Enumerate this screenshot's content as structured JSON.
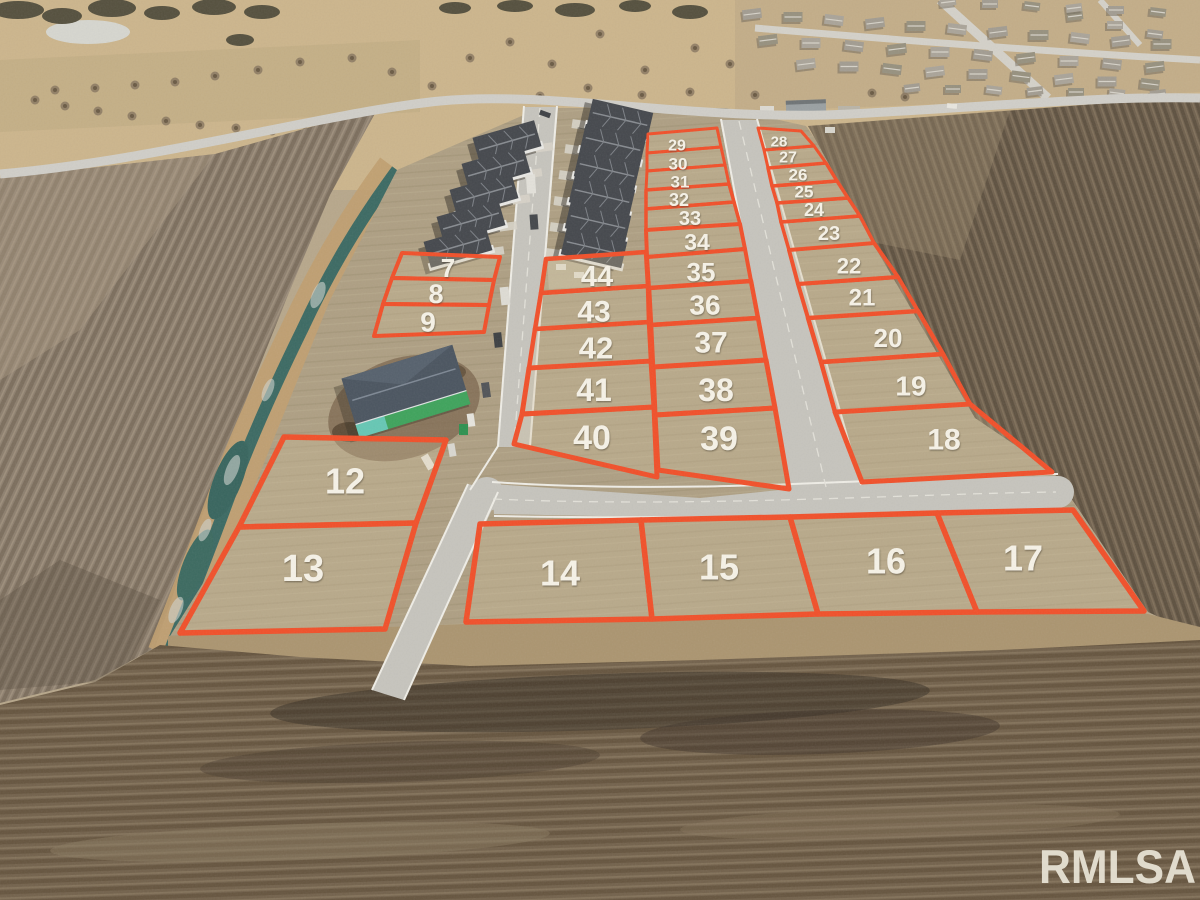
{
  "watermark": {
    "text": "RMLSA",
    "color": "#e7e2d4"
  },
  "overlay": {
    "stroke_color": "#f1502a",
    "label_color": "#f6f2e7"
  },
  "lots": [
    {
      "n": "7",
      "x": 448,
      "y": 268,
      "fs": 26,
      "sw": 4,
      "pts": "402,253 500,257 494,280 392,278"
    },
    {
      "n": "8",
      "x": 436,
      "y": 294,
      "fs": 27,
      "sw": 4,
      "pts": "392,278 494,280 489,305 383,304"
    },
    {
      "n": "9",
      "x": 428,
      "y": 322,
      "fs": 28,
      "sw": 4,
      "pts": "383,304 489,305 484,332 374,336"
    },
    {
      "n": "12",
      "x": 345,
      "y": 481,
      "fs": 36,
      "sw": 5.5,
      "pts": "284,437 446,440 416,523 239,527"
    },
    {
      "n": "13",
      "x": 303,
      "y": 569,
      "fs": 38,
      "sw": 5.5,
      "pts": "239,527 416,523 385,629 180,633"
    },
    {
      "n": "14",
      "x": 560,
      "y": 573,
      "fs": 36,
      "sw": 5.5,
      "pts": "480,524 641,520 652,619 466,622"
    },
    {
      "n": "15",
      "x": 719,
      "y": 567,
      "fs": 36,
      "sw": 5.5,
      "pts": "641,520 790,517 818,614 652,619"
    },
    {
      "n": "16",
      "x": 886,
      "y": 561,
      "fs": 36,
      "sw": 5.5,
      "pts": "790,517 937,513 977,612 818,614"
    },
    {
      "n": "17",
      "x": 1023,
      "y": 558,
      "fs": 36,
      "sw": 5.5,
      "pts": "937,513 1073,510 1144,611 977,612"
    },
    {
      "n": "18",
      "x": 944,
      "y": 440,
      "fs": 30,
      "sw": 5,
      "pts": "835,412 970,404 1052,472 862,482"
    },
    {
      "n": "19",
      "x": 911,
      "y": 386,
      "fs": 28,
      "sw": 4.5,
      "pts": "821,362 943,354 970,404 835,412"
    },
    {
      "n": "20",
      "x": 888,
      "y": 338,
      "fs": 26,
      "sw": 4.5,
      "pts": "808,318 918,311 943,354 821,362"
    },
    {
      "n": "21",
      "x": 862,
      "y": 298,
      "fs": 24,
      "sw": 4,
      "pts": "798,284 898,277 918,311 808,318"
    },
    {
      "n": "22",
      "x": 849,
      "y": 266,
      "fs": 22,
      "sw": 4,
      "pts": "789,250 874,243 898,277 798,284"
    },
    {
      "n": "23",
      "x": 829,
      "y": 234,
      "fs": 20,
      "sw": 3.5,
      "pts": "781,222 860,216 874,243 789,250"
    },
    {
      "n": "24",
      "x": 814,
      "y": 210,
      "fs": 18,
      "sw": 3.5,
      "pts": "777,203 848,198 860,216 781,222"
    },
    {
      "n": "25",
      "x": 804,
      "y": 192,
      "fs": 17,
      "sw": 3.5,
      "pts": "772,186 837,181 848,198 777,203"
    },
    {
      "n": "26",
      "x": 798,
      "y": 175,
      "fs": 17,
      "sw": 3.5,
      "pts": "768,168 826,163 837,181 772,186"
    },
    {
      "n": "27",
      "x": 788,
      "y": 158,
      "fs": 16,
      "sw": 3,
      "pts": "764,150 814,146 826,163 768,168"
    },
    {
      "n": "28",
      "x": 779,
      "y": 142,
      "fs": 15,
      "sw": 3,
      "pts": "758,128 801,131 814,146 764,150"
    },
    {
      "n": "29",
      "x": 677,
      "y": 146,
      "fs": 16,
      "sw": 3,
      "pts": "648,134 717,128 721,147 647,153"
    },
    {
      "n": "30",
      "x": 678,
      "y": 164,
      "fs": 17,
      "sw": 3,
      "pts": "647,153 721,147 725,165 647,171"
    },
    {
      "n": "31",
      "x": 680,
      "y": 182,
      "fs": 17,
      "sw": 3,
      "pts": "647,171 725,165 729,184 646,190"
    },
    {
      "n": "32",
      "x": 679,
      "y": 200,
      "fs": 18,
      "sw": 3.5,
      "pts": "646,190 729,184 734,202 646,209"
    },
    {
      "n": "33",
      "x": 690,
      "y": 219,
      "fs": 20,
      "sw": 3.5,
      "pts": "646,209 734,202 740,224 646,230"
    },
    {
      "n": "34",
      "x": 697,
      "y": 242,
      "fs": 23,
      "sw": 4,
      "pts": "646,230 740,224 745,249 647,257"
    },
    {
      "n": "35",
      "x": 701,
      "y": 272,
      "fs": 26,
      "sw": 4,
      "pts": "647,257 745,249 751,281 649,288"
    },
    {
      "n": "36",
      "x": 705,
      "y": 305,
      "fs": 28,
      "sw": 4.5,
      "pts": "649,288 751,281 758,318 651,325"
    },
    {
      "n": "37",
      "x": 711,
      "y": 343,
      "fs": 30,
      "sw": 4.5,
      "pts": "651,325 758,318 766,360 653,367"
    },
    {
      "n": "38",
      "x": 716,
      "y": 390,
      "fs": 32,
      "sw": 5,
      "pts": "653,367 766,360 775,408 655,415"
    },
    {
      "n": "39",
      "x": 719,
      "y": 439,
      "fs": 34,
      "sw": 5,
      "pts": "655,415 775,408 789,489 658,470"
    },
    {
      "n": "40",
      "x": 592,
      "y": 438,
      "fs": 34,
      "sw": 5,
      "pts": "522,414 654,407 657,477 514,444"
    },
    {
      "n": "41",
      "x": 594,
      "y": 390,
      "fs": 32,
      "sw": 5,
      "pts": "529,368 651,361 654,407 522,414"
    },
    {
      "n": "42",
      "x": 596,
      "y": 348,
      "fs": 31,
      "sw": 4.5,
      "pts": "535,329 649,322 651,361 529,368"
    },
    {
      "n": "43",
      "x": 594,
      "y": 312,
      "fs": 30,
      "sw": 4.5,
      "pts": "541,293 648,286 649,322 535,329"
    },
    {
      "n": "44",
      "x": 597,
      "y": 277,
      "fs": 29,
      "sw": 4.5,
      "pts": "546,259 646,252 648,286 541,293"
    }
  ]
}
